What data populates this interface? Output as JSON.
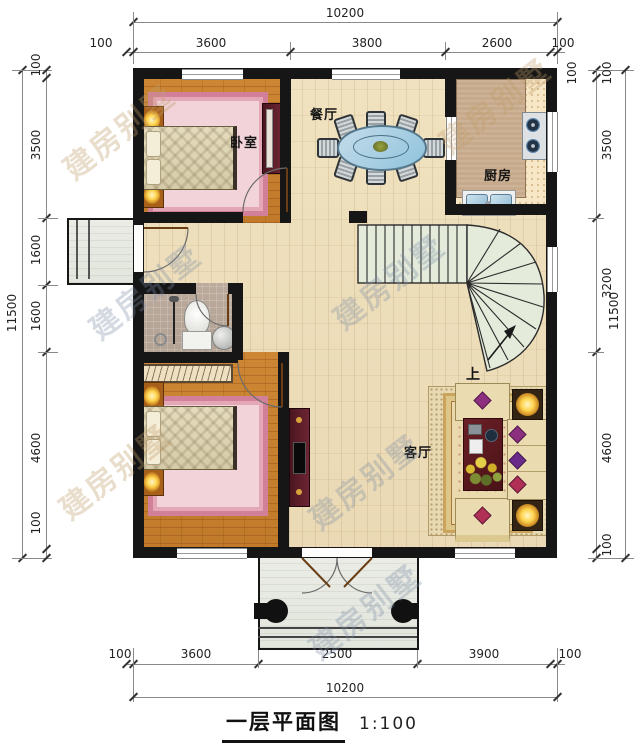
{
  "title": {
    "text": "一层平面图",
    "scale": "1:100"
  },
  "watermark": "建房别墅",
  "rooms": {
    "bedroom_top": "卧室",
    "bedroom_bottom": "卧室",
    "dining": "餐厅",
    "kitchen": "厨房",
    "living": "客厅",
    "stairs_up": "上"
  },
  "dims": {
    "top_total": "10200",
    "top_segments": [
      "100",
      "3600",
      "3800",
      "2600",
      "100"
    ],
    "top_corner": "100",
    "left_total": "11500",
    "left_segments": [
      "100",
      "3500",
      "1600",
      "1600",
      "4600",
      "100"
    ],
    "right_segments": [
      "100",
      "3500",
      "3200",
      "4600",
      "100"
    ],
    "right_total": "11500",
    "bottom_segments": [
      "100",
      "3600",
      "2500",
      "3900",
      "100"
    ],
    "bottom_total": "10200"
  },
  "colors": {
    "wall": "#161616",
    "bedroom_floor": "#c87f2e",
    "main_floor": "#eedfbe",
    "rug_pink": "#e9b9c4",
    "stairs": "#e4ebdb",
    "dining_table": "#9cc6dd",
    "accent_maroon": "#5c1c28"
  }
}
